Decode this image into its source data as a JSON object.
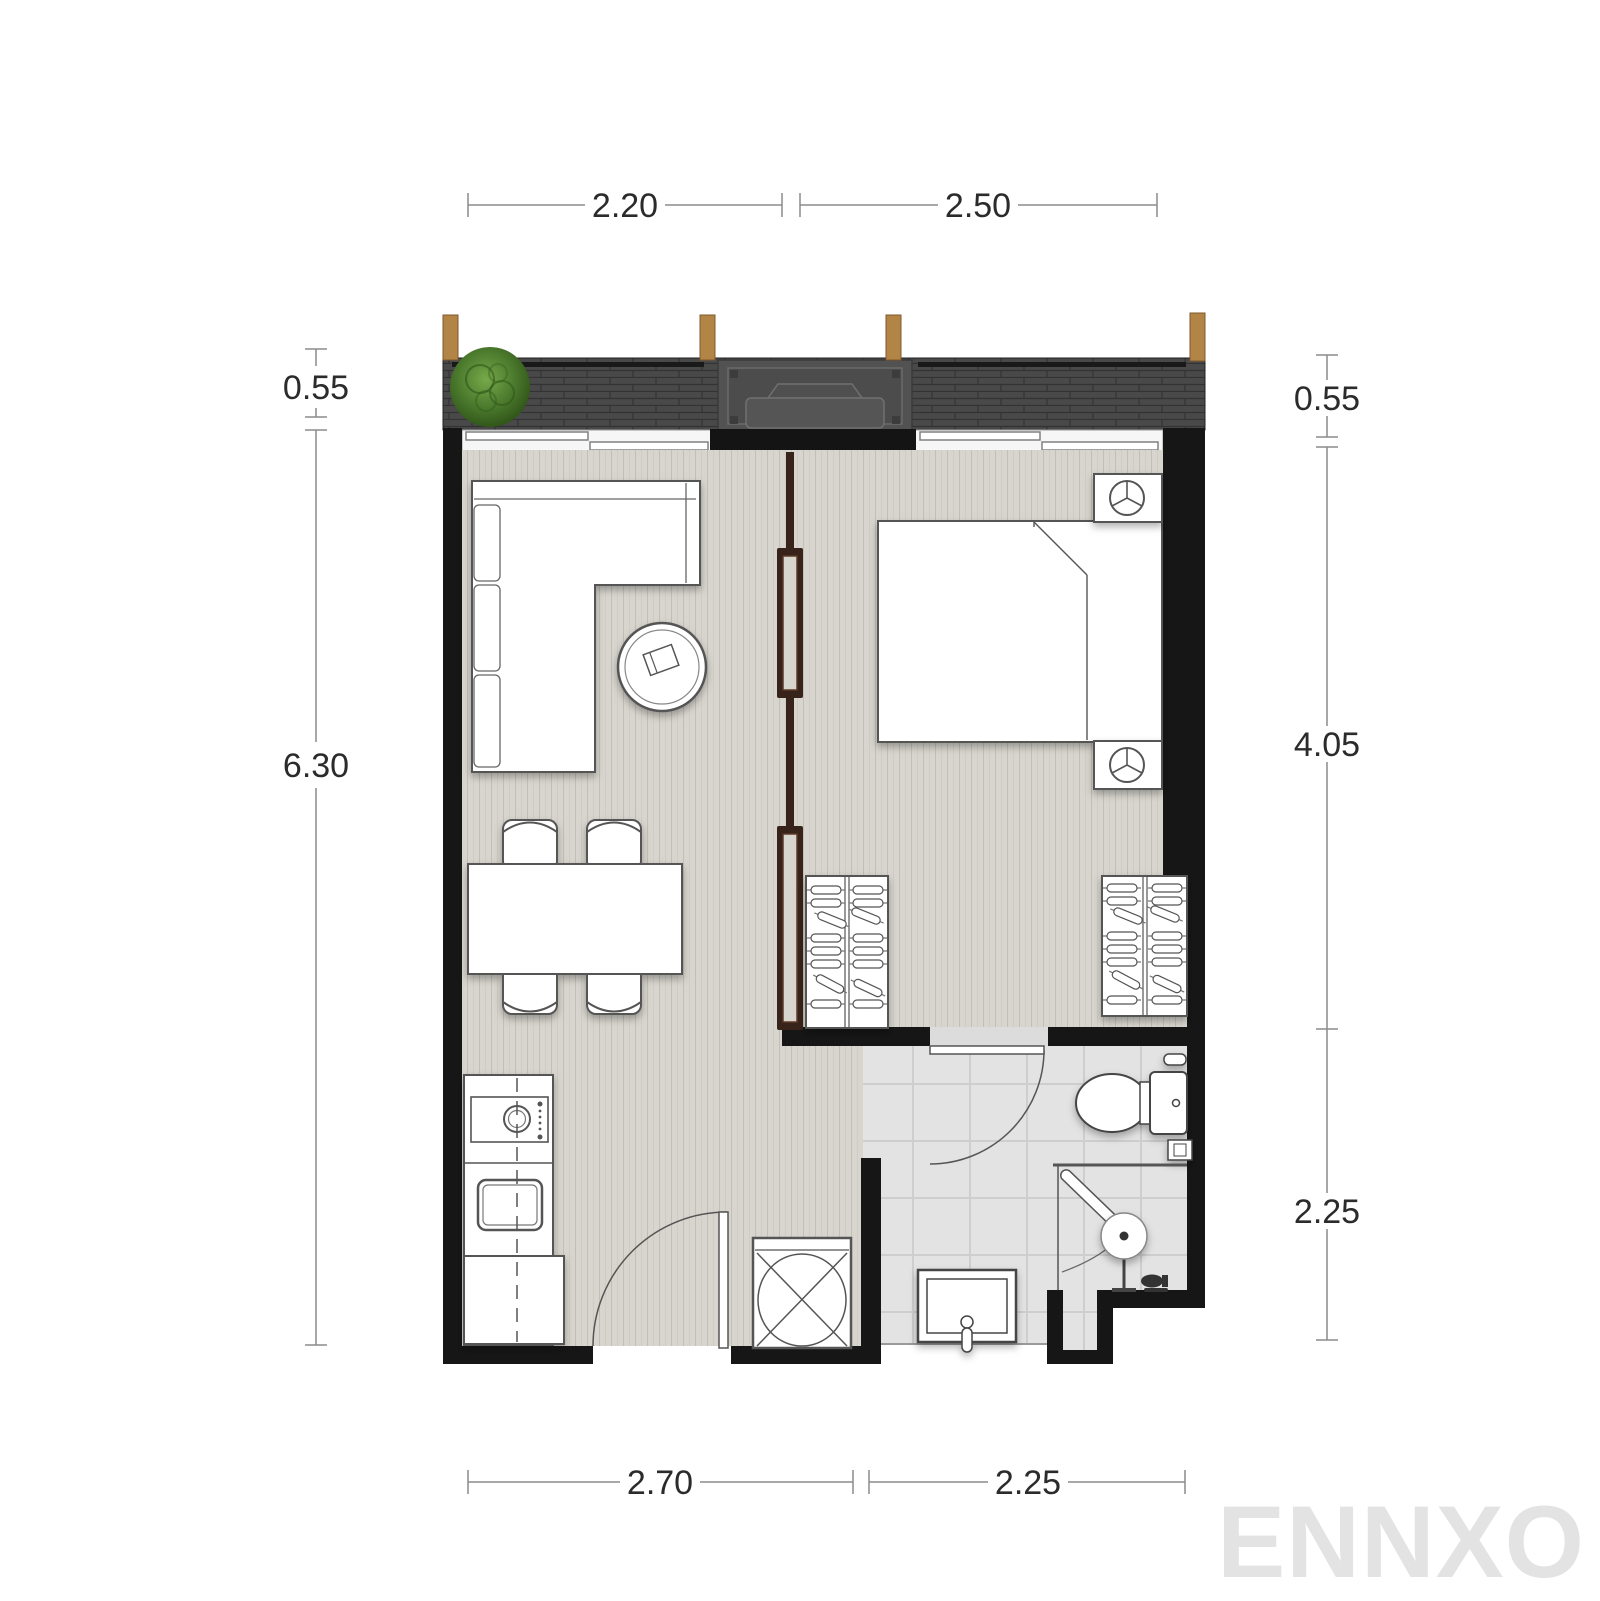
{
  "watermark": {
    "text": "ENNXO",
    "color": "#e3e3e3"
  },
  "dimensions": {
    "top": [
      {
        "label": "2.20"
      },
      {
        "label": "2.50"
      }
    ],
    "left": [
      {
        "label": "0.55"
      },
      {
        "label": "6.30"
      }
    ],
    "right": [
      {
        "label": "0.55"
      },
      {
        "label": "4.05"
      },
      {
        "label": "2.25"
      }
    ],
    "bottom": [
      {
        "label": "2.70"
      },
      {
        "label": "2.25"
      }
    ]
  },
  "colors": {
    "wall": "#161616",
    "floor_plank": "#d8d5ce",
    "floor_tile": "#e3e3e3",
    "balcony": "#494949",
    "wood_post": "#b28445",
    "partition": "#38231a",
    "plant": "#4b7a2d",
    "dimension_line": "#8c8c8c",
    "dimension_text": "#2b2b2b"
  },
  "icons": [
    "plant-icon",
    "ac-unit-icon",
    "sofa-icon",
    "coffee-table-icon",
    "dining-table-icon",
    "dining-chair-icon",
    "bed-icon",
    "nightstand-lamp-icon",
    "wardrobe-hangers-icon",
    "washing-machine-icon",
    "kitchen-sink-icon",
    "service-shaft-icon",
    "entry-door-icon",
    "bathroom-door-icon",
    "toilet-icon",
    "shower-icon",
    "washbasin-icon",
    "window-icon",
    "balcony-railing",
    "sliding-partition"
  ]
}
